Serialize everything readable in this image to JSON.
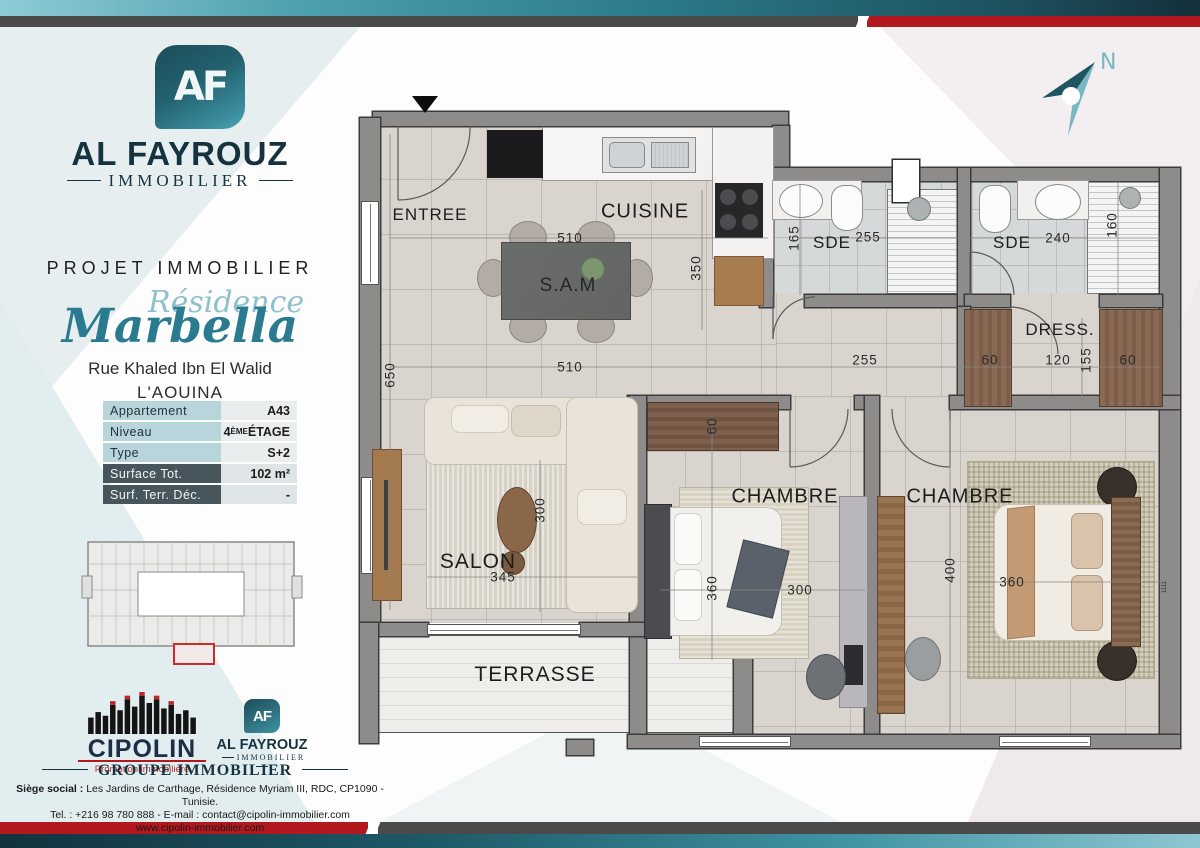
{
  "banners": {
    "top_colors": {
      "teal_gradient": [
        "#8ecbd6",
        "#142f3a"
      ],
      "gray": "#4a4a4a",
      "red": "#b2181d"
    },
    "bottom_colors": {
      "teal_gradient": [
        "#12333d",
        "#8fc6d2"
      ],
      "gray": "#4a4a4a",
      "red": "#b2181d"
    }
  },
  "sidebar": {
    "logo": {
      "monogram": "AF",
      "name": "AL FAYROUZ",
      "subtitle": "IMMOBILIER"
    },
    "project_label": "PROJET IMMOBILIER",
    "residence_script": "Résidence",
    "residence_name": "Marbella",
    "street_line1": "Rue Khaled Ibn El Walid",
    "street_line2": "L'AOUINA",
    "table": {
      "rows": [
        {
          "label": "Appartement",
          "value": "A43"
        },
        {
          "label": "Niveau",
          "value_num": "4",
          "value_sup": "ÈME",
          "value_rest": " ÉTAGE"
        },
        {
          "label": "Type",
          "value": "S+2"
        },
        {
          "label": "Surface Tot.",
          "value": "102 m²"
        },
        {
          "label": "Surf. Terr. Déc.",
          "value": "-"
        }
      ]
    },
    "footer": {
      "cipolin_name": "CIPOLIN",
      "cipolin_tagline": "Promotion immobilière",
      "af_monogram": "AF",
      "af_name": "AL FAYROUZ",
      "af_subtitle": "IMMOBILIER",
      "group_label": "GROUPE IMMOBILIER",
      "siege_bold": "Siège social :",
      "siege_rest": " Les Jardins de Carthage, Résidence Myriam III, RDC, CP1090 - Tunisie.",
      "contact_line": "Tel. : +216 98 780 888 -  E-mail : contact@cipolin-immobilier.com",
      "website": "www.cipolin-immobilier.com"
    }
  },
  "compass": {
    "label": "N"
  },
  "plan": {
    "rooms": {
      "entree": "ENTREE",
      "cuisine": "CUISINE",
      "sam": "S.A.M",
      "sde1": "SDE",
      "sde2": "SDE",
      "dress": "DRESS.",
      "salon": "SALON",
      "chambre1": "CHAMBRE",
      "chambre2": "CHAMBRE",
      "terrasse": "TERRASSE"
    },
    "dims": {
      "d510a": "510",
      "d510b": "510",
      "d350": "350",
      "d165": "165",
      "d255sde": "255",
      "d240": "240",
      "d160": "160",
      "d255hall": "255",
      "d650": "650",
      "d60w": "60",
      "d60a": "60",
      "d120": "120",
      "d155": "155",
      "d60b": "60",
      "d345": "345",
      "d300salon": "300",
      "d360ch1": "360",
      "d300ch1": "300",
      "d400": "400",
      "d360ch2": "360",
      "d1111": "1111"
    }
  }
}
